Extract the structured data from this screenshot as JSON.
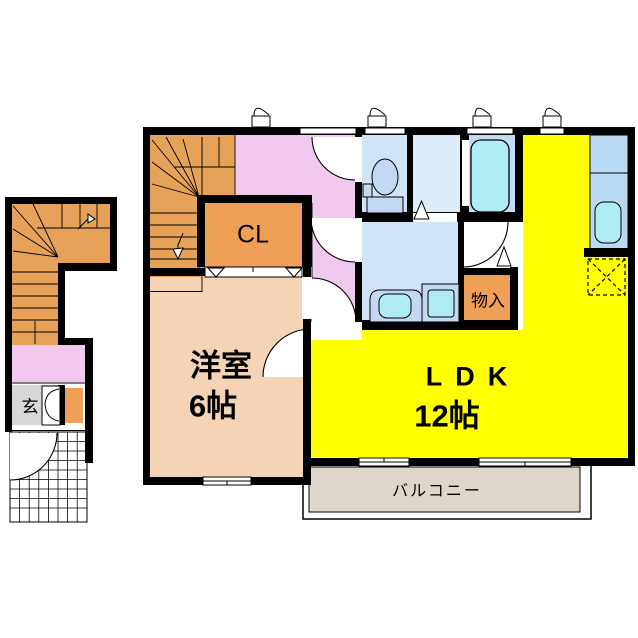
{
  "floor_plan": {
    "type": "japanese-apartment-floorplan-2F",
    "wall_color": "#000000",
    "rooms": [
      {
        "name": "ldk",
        "label": "LDK",
        "size_label": "12帖",
        "color": "#ffff00"
      },
      {
        "name": "western-room",
        "label": "洋室",
        "size_label": "6帖",
        "color": "#f4d4b4"
      },
      {
        "name": "closet",
        "label": "CL",
        "color": "#ef9f56"
      },
      {
        "name": "storage",
        "label": "物入",
        "color": "#ef9f56"
      },
      {
        "name": "entrance",
        "label": "玄",
        "color": "#d7d7d7"
      },
      {
        "name": "balcony",
        "label": "バルコニー",
        "color": "#ded6cb"
      },
      {
        "name": "hallway",
        "label": "",
        "color": "#f1c9ef"
      },
      {
        "name": "staircase",
        "label": "",
        "color": "#e6a259"
      },
      {
        "name": "toilet-room",
        "label": "",
        "color": "#cfe4f7"
      },
      {
        "name": "linen-room",
        "label": "",
        "color": "#dcecfb"
      },
      {
        "name": "bathroom",
        "label": "",
        "color": "#c3dcf5"
      },
      {
        "name": "washroom",
        "label": "",
        "color": "#cfe4f7"
      },
      {
        "name": "kitchen-counter",
        "label": "",
        "color": "#badaf3"
      }
    ],
    "fixtures": [
      "toilet",
      "bathtub",
      "kitchen-sink",
      "washbasin",
      "washing-machine",
      "refrigerator-space"
    ],
    "fixture_fill": "#b0ecf4",
    "fixture_body": "#c3d9f3"
  },
  "labels": {
    "cl": "CL",
    "western_room": "洋室",
    "western_room_size": "6帖",
    "ldk": "LDK",
    "ldk_size": "12帖",
    "storage": "物入",
    "entrance": "玄",
    "balcony": "バルコニー"
  }
}
